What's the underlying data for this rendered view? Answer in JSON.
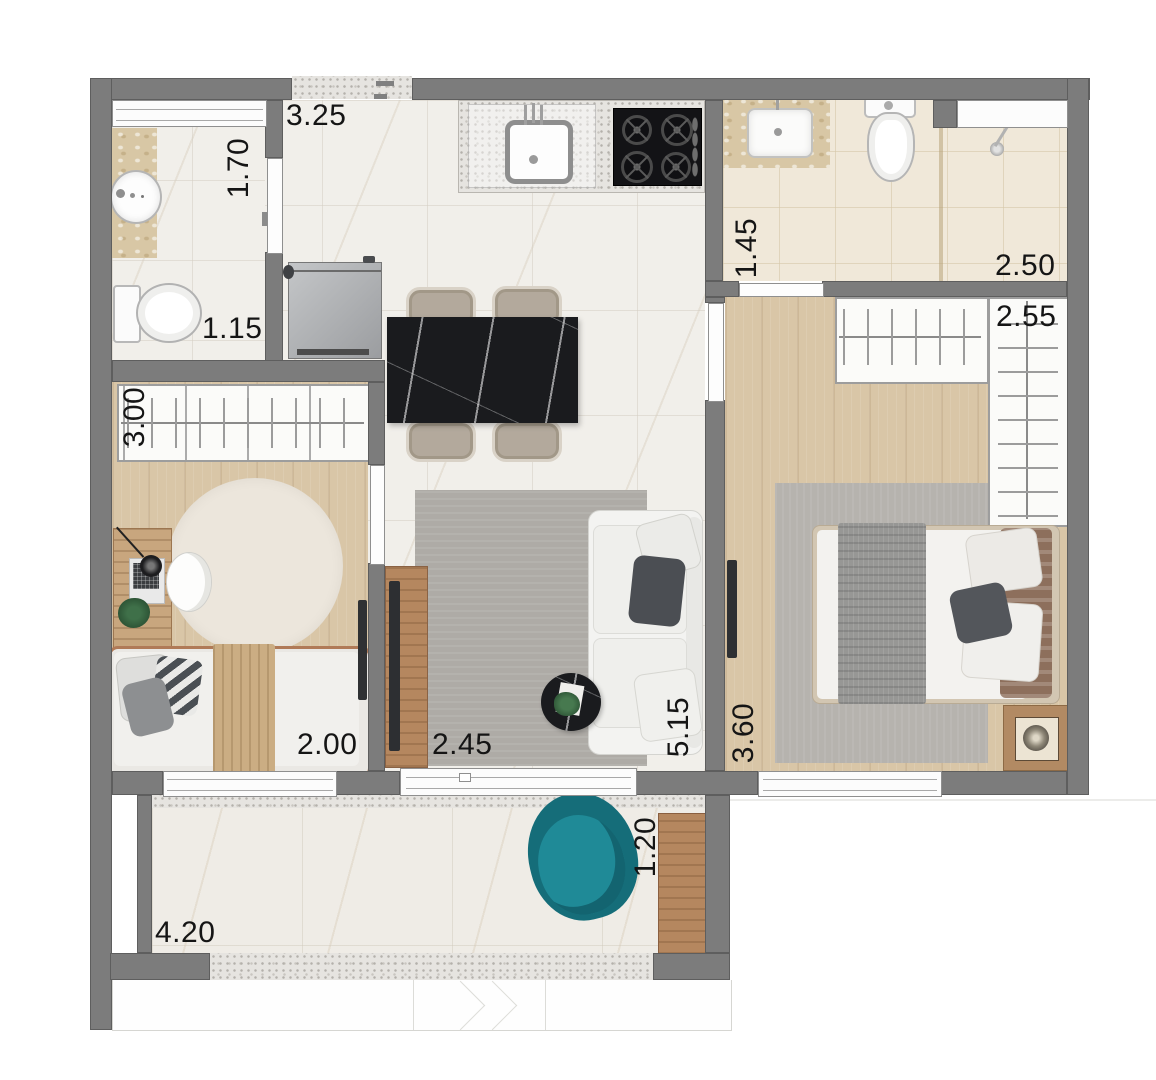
{
  "floorplan": {
    "type": "apartment-floor-plan",
    "dimensions": {
      "entry_hall_width": "3.25",
      "bathroom1_depth": "1.70",
      "bathroom1_width": "1.15",
      "bathroom2_width": "1.45",
      "bathroom2_depth": "2.50",
      "bedroom1_wardrobe_width": "2.55",
      "bedroom2_closet_width": "3.00",
      "bedroom2_width": "2.00",
      "living_width": "2.45",
      "living_depth": "5.15",
      "bedroom1_depth": "3.60",
      "balcony_depth": "1.20",
      "balcony_width": "4.20"
    },
    "colors": {
      "wall": "#7c7c7c",
      "marble_floor": "#f1efea",
      "wood_floor": "#d9c6a7",
      "beige_tile": "#f0e8d9",
      "black_marble": "#1a1b1e",
      "accent_teal": "#1b7e8b",
      "rug_gray": "#aeaba6"
    }
  }
}
